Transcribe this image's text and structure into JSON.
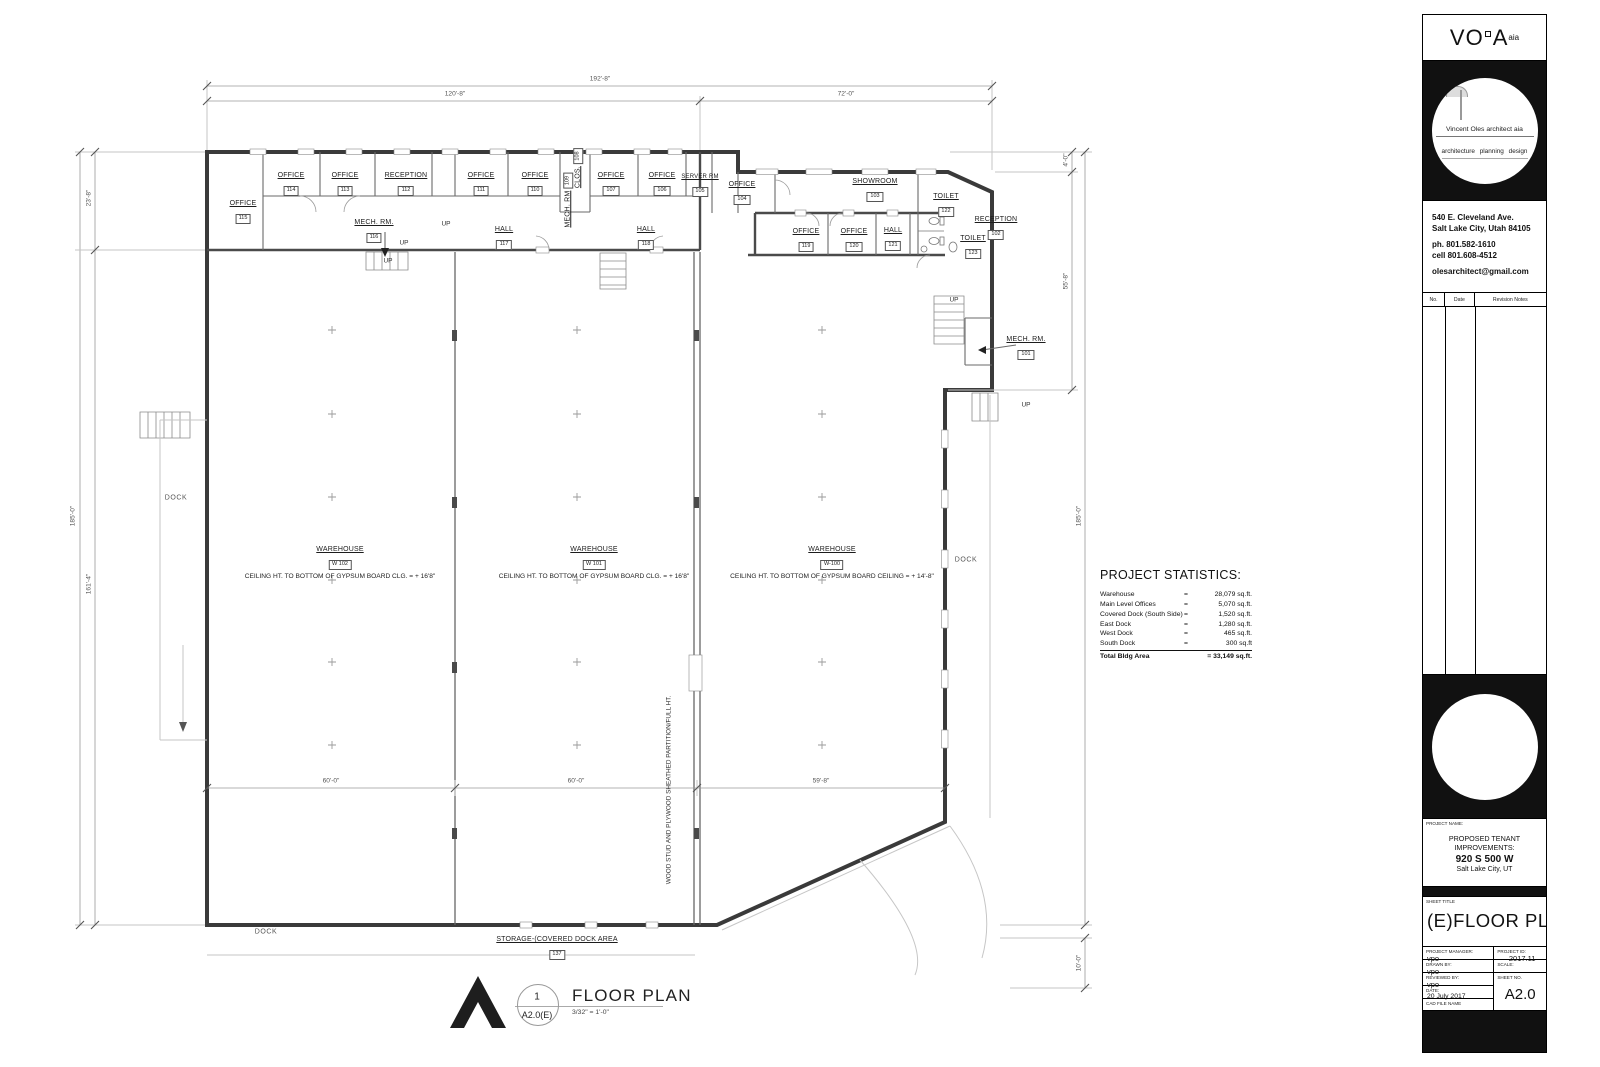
{
  "rooms": {
    "office_115": {
      "name": "OFFICE",
      "tag": "115"
    },
    "office_114": {
      "name": "OFFICE",
      "tag": "114"
    },
    "office_113": {
      "name": "OFFICE",
      "tag": "113"
    },
    "reception_112": {
      "name": "RECEPTION",
      "tag": "112"
    },
    "mech_116": {
      "name": "MECH. RM.",
      "tag": "116"
    },
    "office_111": {
      "name": "OFFICE",
      "tag": "111"
    },
    "office_110": {
      "name": "OFFICE",
      "tag": "110"
    },
    "clos_108": {
      "name": "CLOS.",
      "tag": "108"
    },
    "mech_109": {
      "name": "MECH. RM",
      "tag": "109"
    },
    "office_107": {
      "name": "OFFICE",
      "tag": "107"
    },
    "office_106": {
      "name": "OFFICE",
      "tag": "106"
    },
    "server_105": {
      "name": "SERVER RM",
      "tag": "105"
    },
    "office_104": {
      "name": "OFFICE",
      "tag": "104"
    },
    "showroom_103": {
      "name": "SHOWROOM",
      "tag": "103"
    },
    "toilet_122": {
      "name": "TOILET",
      "tag": "122"
    },
    "reception_102": {
      "name": "RECEPTION",
      "tag": "102"
    },
    "office_119": {
      "name": "OFFICE",
      "tag": "119"
    },
    "office_120": {
      "name": "OFFICE",
      "tag": "120"
    },
    "hall_121": {
      "name": "HALL",
      "tag": "121"
    },
    "toilet_123": {
      "name": "TOILET",
      "tag": "123"
    },
    "hall_117": {
      "name": "HALL",
      "tag": "117"
    },
    "hall_118": {
      "name": "HALL",
      "tag": "118"
    },
    "mech_101": {
      "name": "MECH. RM.",
      "tag": "101"
    },
    "warehouse_w102": {
      "name": "WAREHOUSE",
      "tag": "W 102",
      "note": "CEILING HT. TO BOTTOM OF GYPSUM BOARD CLG. = + 16'8\""
    },
    "warehouse_w101": {
      "name": "WAREHOUSE",
      "tag": "W 101",
      "note": "CEILING HT. TO BOTTOM OF GYPSUM BOARD CLG. = + 16'8\""
    },
    "warehouse_w100": {
      "name": "WAREHOUSE",
      "tag": "W-100",
      "note": "CEILING HT. TO BOTTOM OF GYPSUM BOARD CEILING  = + 14'-8\""
    },
    "storage_137": {
      "name": "STORAGE-(COVERED DOCK AREA",
      "tag": "137"
    }
  },
  "labels": {
    "up": "UP",
    "dock": "DOCK",
    "partition_note": "WOOD STUD AND PLYWOOD SHEATHED PARTITION/FULL HT."
  },
  "dimensions": {
    "top_overall": "192'-8\"",
    "top_left": "120'-8\"",
    "top_right": "72'-0\"",
    "left_full": "185'-0\"",
    "left_top": "23'-8\"",
    "left_lower": "161'-4\"",
    "right_top": "4'-0\"",
    "right_mid": "55'-8\"",
    "right_full": "185'-0\"",
    "right_low": "10'-0\"",
    "bay_1": "60'-0\"",
    "bay_2": "60'-0\"",
    "bay_3": "59'-8\""
  },
  "stats": {
    "title": "PROJECT STATISTICS:",
    "rows": [
      {
        "label": "Warehouse",
        "eq": "=",
        "value": "28,079 sq.ft."
      },
      {
        "label": "Main Level Offices",
        "eq": "=",
        "value": "5,070 sq.ft."
      },
      {
        "label": "Covered Dock (South Side)",
        "eq": "=",
        "value": "1,520 sq.ft."
      },
      {
        "label": "East Dock",
        "eq": "=",
        "value": "1,280 sq.ft."
      },
      {
        "label": "West Dock",
        "eq": "=",
        "value": "465 sq.ft."
      },
      {
        "label": "South Dock",
        "eq": "=",
        "value": "300 sq.ft"
      }
    ],
    "total_label": "Total Bldg Area",
    "total_value": "= 33,149 sq.ft."
  },
  "plan_title": {
    "number": "1",
    "ref": "A2.0(E)",
    "title": "FLOOR PLAN",
    "scale": "3/32\" = 1'-0\""
  },
  "title_block": {
    "logo_vo": "VO",
    "logo_a": "A",
    "logo_aia": "aia",
    "tagline1": "Vincent Oles architect aia",
    "tagline2": "architecture planning design",
    "address1": "540 E. Cleveland Ave.",
    "address2": "Salt Lake City, Utah 84105",
    "phone": "ph. 801.582-1610",
    "cell": "cell 801.608-4512",
    "email": "olesarchitect@gmail.com",
    "rev_no": "No.",
    "rev_date": "Date",
    "rev_notes": "Revision Notes",
    "project_name_label": "PROJECT NAME:",
    "project_name1": "PROPOSED TENANT IMPROVEMENTS:",
    "project_name2": "920 S 500 W",
    "project_name3": "Salt Lake City, UT",
    "sheet_title_label": "SHEET TITLE",
    "sheet_title": "(E)FLOOR  PLAN",
    "pm_label": "PROJECT MANAGER:",
    "pm": "vpo",
    "pid_label": "PROJECT ID:",
    "pid": "2017.11",
    "drawn_label": "DRAWN BY:",
    "drawn": "vpo",
    "scale_label": "SCALE:",
    "reviewed_label": "REVIEWED BY:",
    "reviewed": "vpo",
    "sheetno_label": "SHEET NO.",
    "sheetno": "A2.0",
    "date_label": "DATE:",
    "date": "20 July 2017",
    "cad_label": "CAD FILE NAME"
  }
}
